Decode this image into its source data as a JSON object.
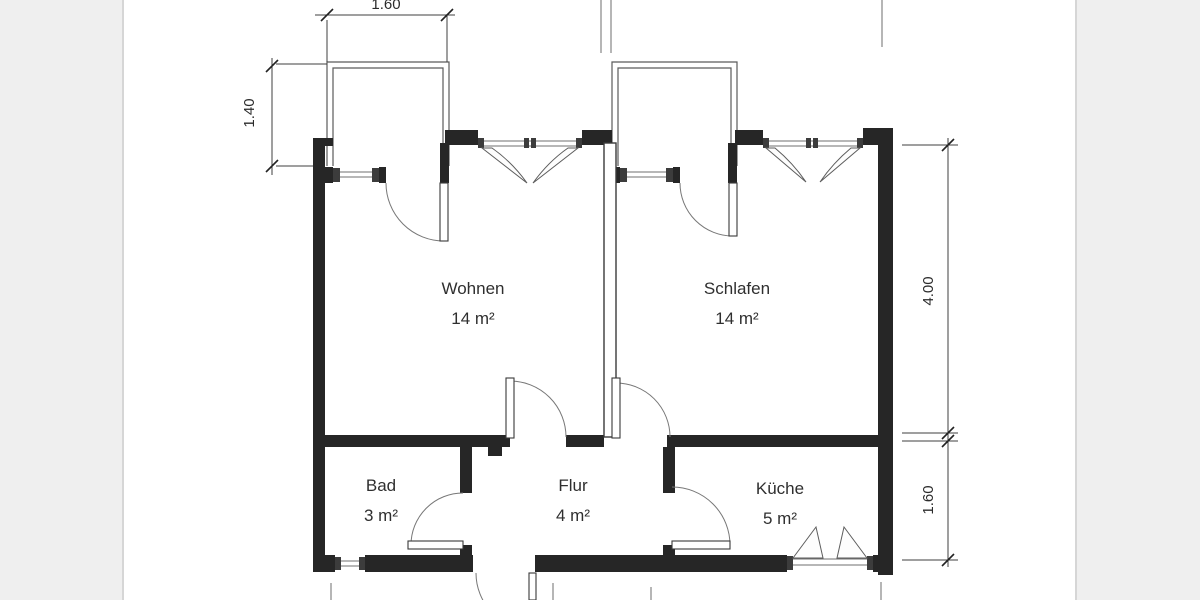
{
  "rooms": [
    {
      "id": "wohnen",
      "name": "Wohnen",
      "area": "14 m²"
    },
    {
      "id": "schlafen",
      "name": "Schlafen",
      "area": "14 m²"
    },
    {
      "id": "bad",
      "name": "Bad",
      "area": "3 m²"
    },
    {
      "id": "flur",
      "name": "Flur",
      "area": "4 m²"
    },
    {
      "id": "kueche",
      "name": "Küche",
      "area": "5 m²"
    }
  ],
  "dimensions": {
    "balcony_width": "1.60",
    "balcony_depth": "1.40",
    "right_upper": "4.00",
    "right_lower": "1.60"
  },
  "colors": {
    "wall": "#262626",
    "line": "#555555",
    "text": "#2f2f2f",
    "page": "#ffffff",
    "background": "#eeeeee",
    "page_edge": "#d6d6d6"
  }
}
